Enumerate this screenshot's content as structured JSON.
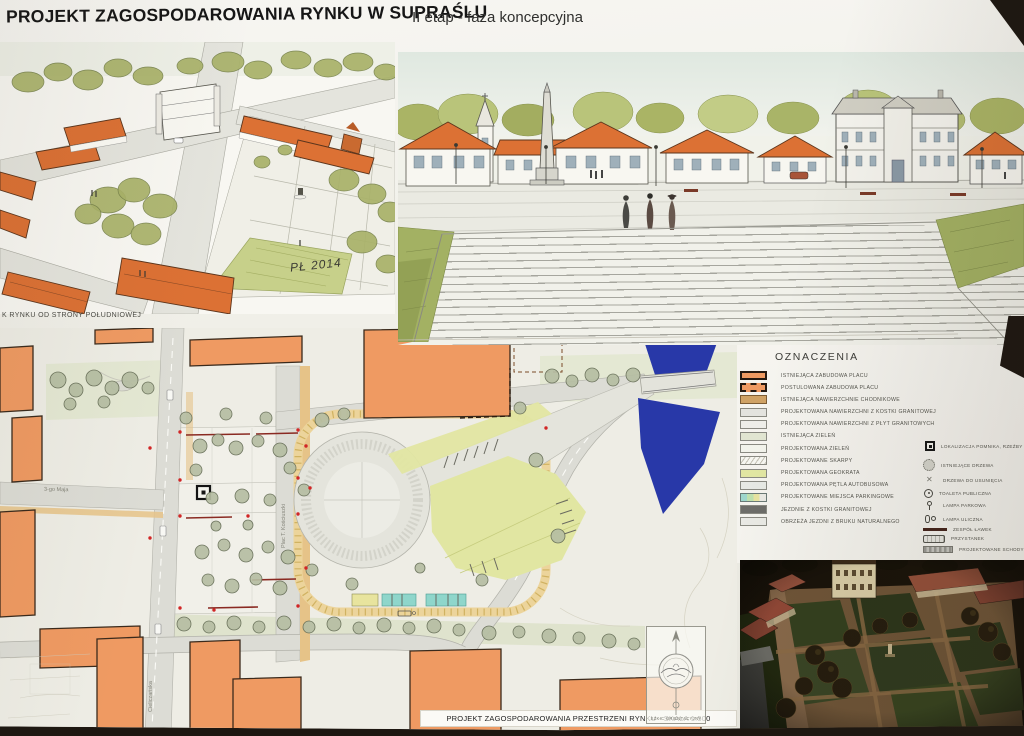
{
  "poster": {
    "title": "PROJEKT ZAGOSPODAROWANIA RYNKU W SUPRAŚLU",
    "subtitle": "II etap - faza koncepcyjna"
  },
  "sketches": {
    "south_view_caption": "K RYNKU OD STRONY POŁUDNIOWEJ",
    "east_view_caption": "WIDOK RYNKU OD STRONY WSCHODNIEJ",
    "east_signature": "PŁ 2014",
    "south_signature": "PŁ 2014"
  },
  "plan": {
    "caption": "PROJEKT ZAGOSPODAROWANIA PRZESTRZENI RYNKU - SKALA 1:500",
    "street_labels": {
      "west_street": "3-go Maja",
      "square": "Plac T. Kościuszki",
      "south_street": "Cieliczańska"
    },
    "compass_label": "SZKIC ORIENTACYJNY"
  },
  "legend": {
    "title": "OZNACZENIA",
    "surface_items": [
      {
        "label": "ISTNIEJĄCA ZABUDOWA PLACU",
        "swatch": "existing-building"
      },
      {
        "label": "POSTULOWANA ZABUDOWA PLACU",
        "swatch": "postulated-building"
      },
      {
        "label": "ISTNIEJĄCA NAWIERZCHNIE CHODNIKOWE",
        "swatch": "existing-sidewalk"
      },
      {
        "label": "PROJEKTOWANA NAWIERZCHNI Z KOSTKI GRANITOWEJ",
        "swatch": "granite-cobble"
      },
      {
        "label": "PROJEKTOWANA NAWIERZCHNI Z PŁYT GRANITOWYCH",
        "swatch": "granite-slab"
      },
      {
        "label": "ISTNIEJĄCA ZIELEŃ",
        "swatch": "existing-green"
      },
      {
        "label": "PROJEKTOWANA ZIELEŃ",
        "swatch": "planned-green"
      },
      {
        "label": "PROJEKTOWANE SKARPY",
        "swatch": "slopes"
      },
      {
        "label": "PROJEKTOWANA GEOKRATA",
        "swatch": "geogrid"
      },
      {
        "label": "PROJEKTOWANA PĘTLA AUTOBUSOWA",
        "swatch": "bus-loop"
      },
      {
        "label": "PROJEKTOWANE MIEJSCA PARKINGOWE",
        "swatch": "parking"
      },
      {
        "label": "JEZDNIE Z KOSTKI GRANITOWEJ",
        "swatch": "roadway"
      },
      {
        "label": "OBRZEŻA JEZDNI Z BRUKU NATURALNEGO",
        "swatch": "road-edge"
      }
    ],
    "symbol_items": [
      {
        "label": "LOKALIZACJA POMNIKA, RZEŹBY",
        "icon": "monument"
      },
      {
        "label": "ISTNIEJĄCE DRZEWA",
        "icon": "tree"
      },
      {
        "label": "DRZEWA DO USUNIĘCIA",
        "icon": "tree-remove"
      },
      {
        "label": "TOALETA PUBLICZNA",
        "icon": "toilet"
      },
      {
        "label": "LAMPA PARKOWA",
        "icon": "park-lamp"
      },
      {
        "label": "LAMPA ULICZNA",
        "icon": "street-lamp"
      },
      {
        "label": "ZESPÓŁ ŁAWEK",
        "icon": "benches"
      },
      {
        "label": "PRZYSTANEK",
        "icon": "bus-stop"
      },
      {
        "label": "PROJEKTOWANE SCHODY",
        "icon": "stairs"
      }
    ]
  },
  "colors": {
    "paper": "#f2f1ea",
    "dark_backdrop": "#1d1711",
    "building_existing": "#ef9a62",
    "sidewalk_tan": "#e6c388",
    "road_gray": "#dcdcd5",
    "river_blue": "#2838a8",
    "geogrid_green": "#e1e6a2",
    "parking_teal": "#8fd6cb",
    "roof_orange": "#dc7134",
    "sketch_green": "#aab465"
  }
}
